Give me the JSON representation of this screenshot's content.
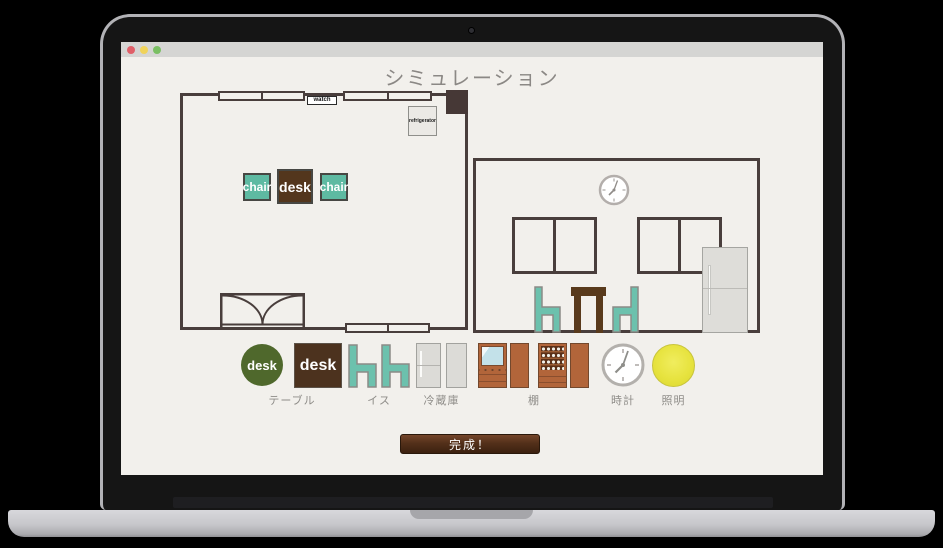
{
  "chrome": {
    "traffic_lights": [
      "#e05f68",
      "#f0d35a",
      "#7abf63"
    ]
  },
  "app": {
    "title": "シミュレーション",
    "finish_button": "完成！"
  },
  "plan_room": {
    "watch": "watch",
    "refrigerator": "refrigerator",
    "chair_left": "chair",
    "desk": "desk",
    "chair_right": "chair"
  },
  "toolbar": {
    "table_icon_circle_text": "desk",
    "table_icon_square_text": "desk",
    "labels": {
      "table": "テーブル",
      "chair": "イス",
      "refrigerator": "冷蔵庫",
      "shelf": "棚",
      "clock": "時計",
      "light": "照明"
    }
  },
  "colors": {
    "wall": "#493e3c",
    "chair_teal": "#5ebaa2",
    "desk_brown": "#53361d",
    "toolbar_green": "#4f682c",
    "shelf_sienna": "#b2653a",
    "light_yellow": "#e7e33f",
    "button_brown": "#53301a"
  }
}
